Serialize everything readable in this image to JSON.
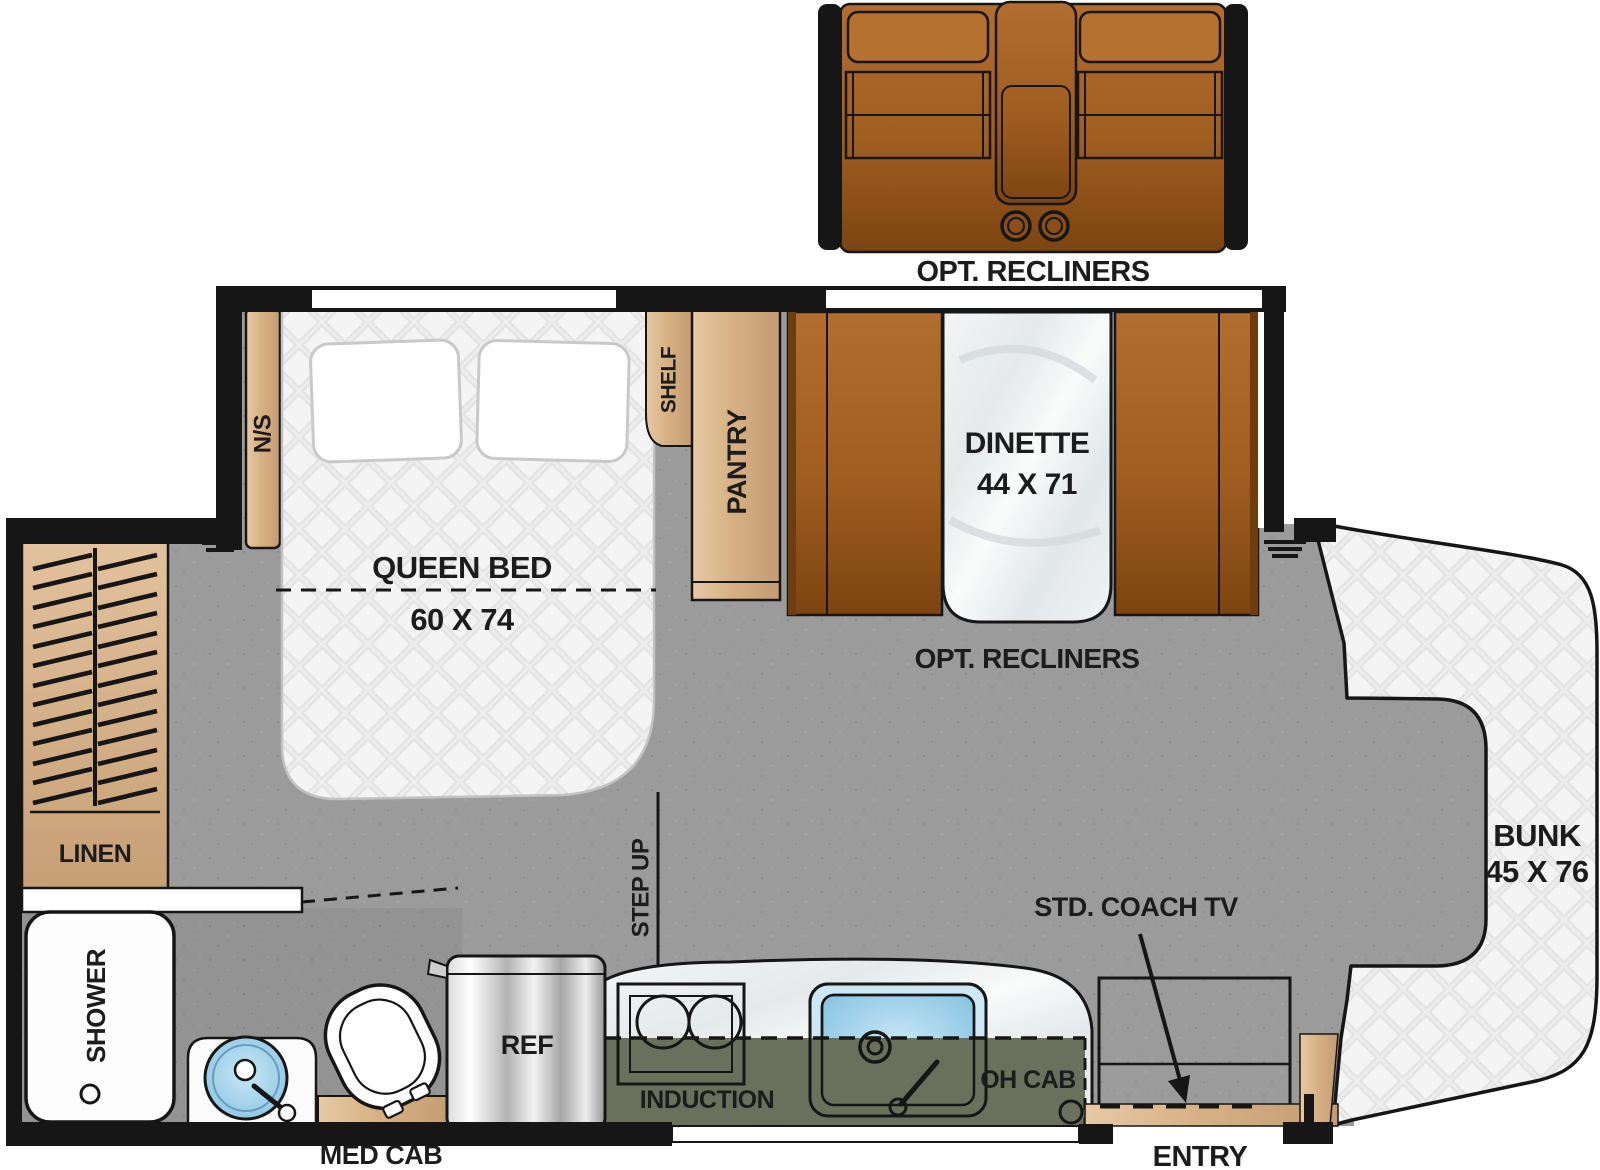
{
  "floorplan": {
    "recliner_slideout": {
      "label": "OPT. RECLINERS"
    },
    "dinette": {
      "label": "DINETTE",
      "size": "44 X 71",
      "recliners_option_label": "OPT. RECLINERS"
    },
    "bedroom": {
      "bed_label": "QUEEN BED",
      "bed_size": "60 X 74",
      "nightstand_label": "N/S",
      "shelf_label": "SHELF",
      "pantry_label": "PANTRY"
    },
    "bath": {
      "linen_label": "LINEN",
      "shower_label": "SHOWER",
      "med_cab_label": "MED CAB"
    },
    "kitchen": {
      "ref_label": "REF",
      "induction_label": "INDUCTION",
      "oh_cab_label": "OH CAB"
    },
    "living": {
      "tv_label": "STD. COACH TV",
      "entry_label": "ENTRY",
      "step_up_label": "STEP UP"
    },
    "bunk": {
      "label": "BUNK",
      "size": "45 X 76"
    },
    "colors": {
      "wall": "#161616",
      "floor": "#9b9b9b",
      "wood": "#d7b184",
      "upholstery_brown": "#a05d20",
      "overhead_cabinet_olive": "#6a705c",
      "sink_blue": "#7fbede",
      "mattress_white": "#f4f4f4"
    }
  }
}
